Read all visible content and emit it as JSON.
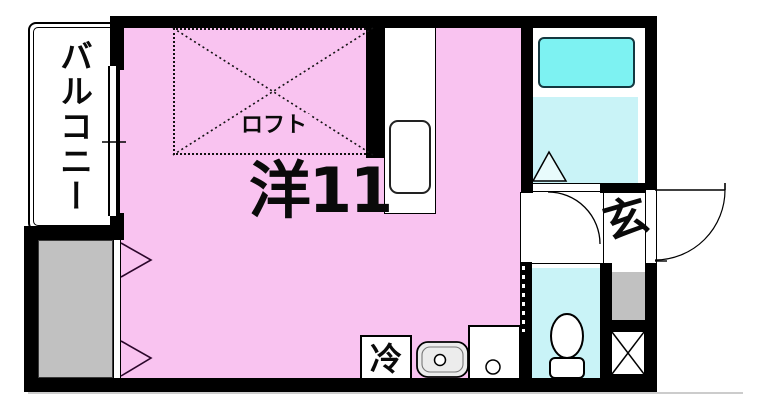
{
  "floorplan": {
    "type": "japanese-apartment-floor-plan",
    "labels": {
      "balcony": "バルコニー",
      "loft": "ロフト",
      "main_room": "洋11",
      "entrance": "玄",
      "refrigerator": "冷"
    },
    "colors": {
      "room_pink": "#f9c3f0",
      "bathtub_cyan": "#7df2f2",
      "wet_cyan": "#c9f3f7",
      "closet_gray": "#c1c1c1",
      "basin_gray": "#ececec",
      "wall_black": "#000000"
    },
    "fixtures": [
      "bathtub",
      "bath-floor",
      "bathroom-triangle-marker",
      "sliding-door",
      "interior-door-arc",
      "entrance-door-arc",
      "toilet",
      "kitchen-counter",
      "kitchen-sink",
      "washbasin",
      "washing-machine-pan",
      "refrigerator-box",
      "shoe-cabinet",
      "storage-x-box",
      "closet-folding-doors",
      "balcony-window",
      "loft-dotted-area"
    ]
  }
}
